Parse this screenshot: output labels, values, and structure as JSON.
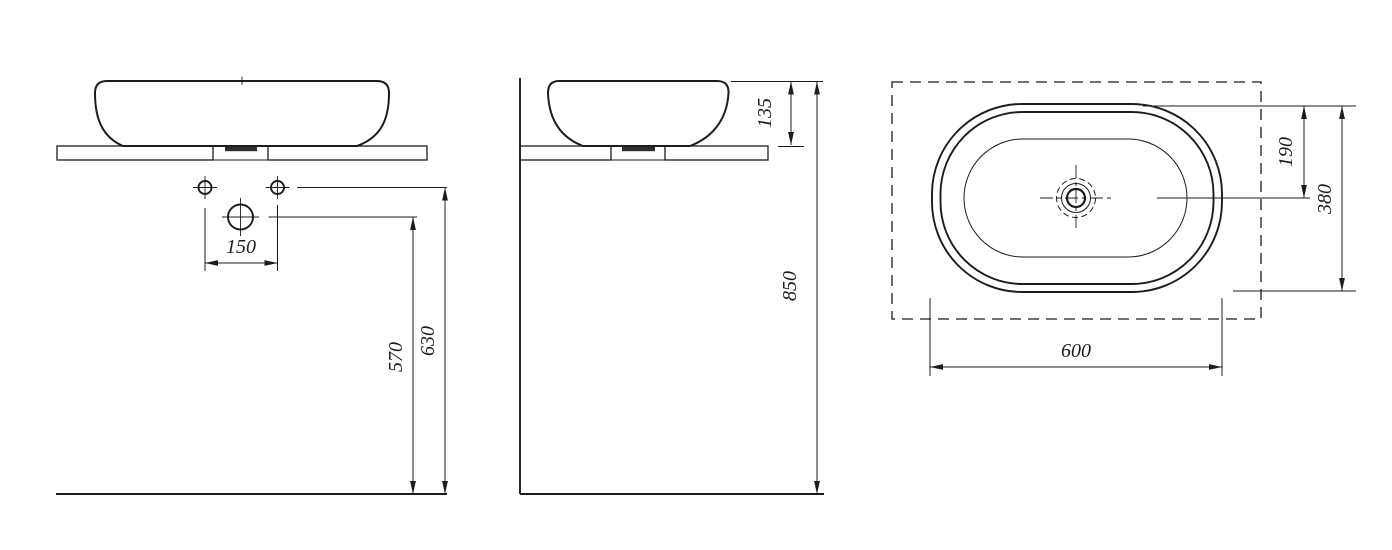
{
  "title": "Countertop washbasin installation drawing",
  "units": "mm",
  "colors": {
    "line": "#1c1c1c",
    "background": "#ffffff"
  },
  "views": {
    "front": {
      "name": "front-view",
      "dimensions": {
        "tap_hole_spacing": "150",
        "drain_outlet_height": "570",
        "tap_holes_height": "630"
      }
    },
    "side": {
      "name": "side-view",
      "dimensions": {
        "basin_height_above_counter": "135",
        "rim_height_from_floor": "850"
      }
    },
    "top": {
      "name": "top-view",
      "dimensions": {
        "drain_center_offset": "190",
        "basin_depth": "380",
        "basin_width": "600"
      }
    }
  }
}
